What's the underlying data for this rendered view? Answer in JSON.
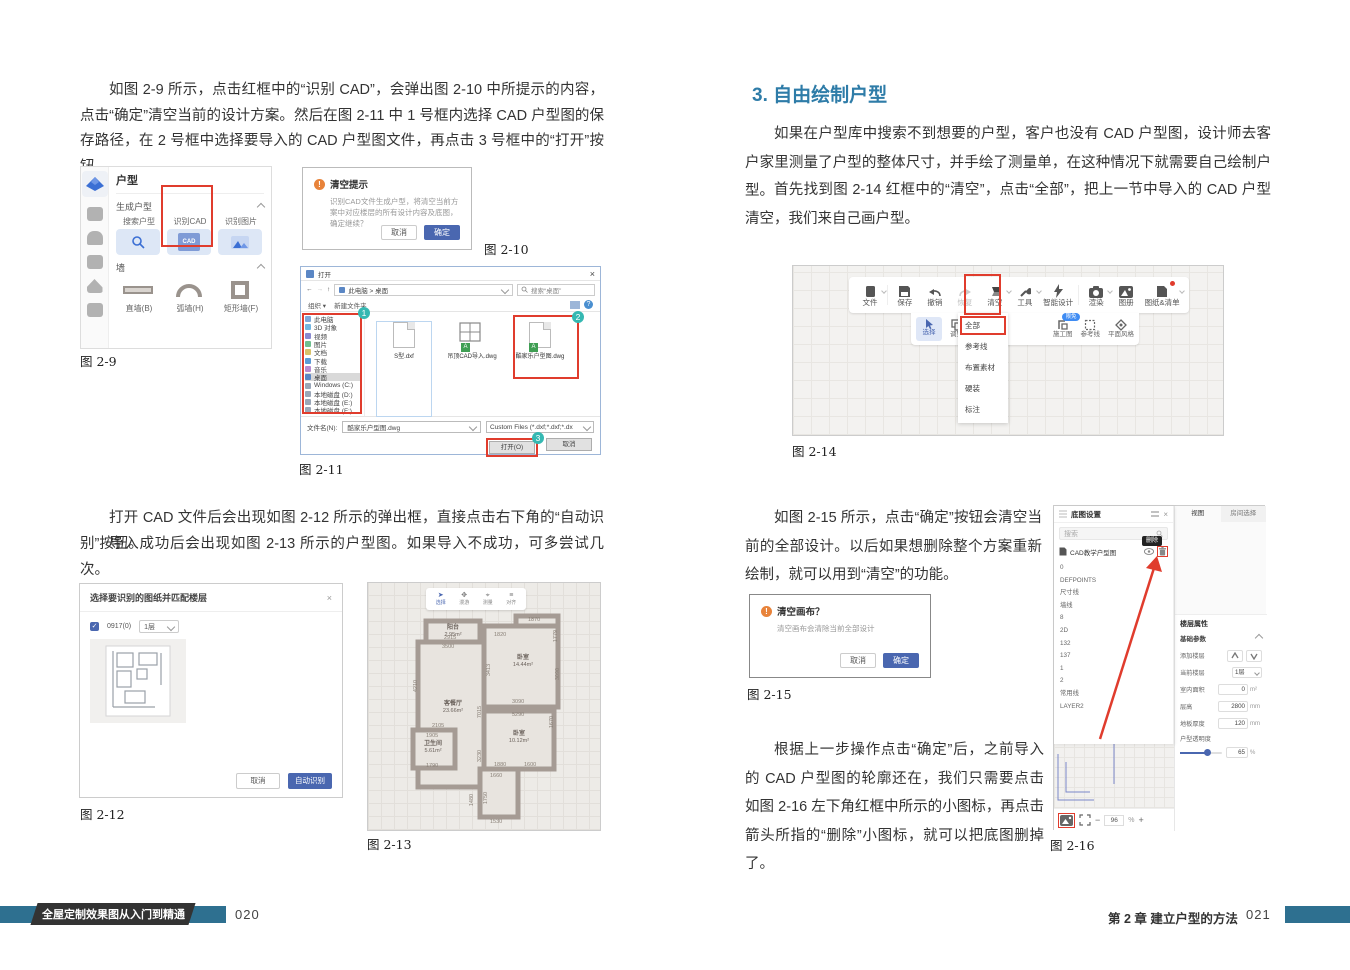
{
  "pl": {
    "para1": "如图 2-9 所示，点击红框中的“识别 CAD”，会弹出图 2-10 中所提示的内容，点击“确定”清空当前的设计方案。然后在图 2-11 中 1 号框内选择 CAD 户型图的保存路径，在 2 号框中选择要导入的 CAD 户型图文件，再点击 3 号框中的“打开”按钮。",
    "para2a": "打开 CAD 文件后会出现如图 2-12 所示的弹出框，直接点击右下角的“自动识别”按钮。",
    "para2b": "导入成功后会出现如图 2-13 所示的户型图。如果导入不成功，可多尝试几次。",
    "fig9": {
      "caption": "图 2-9",
      "title": "户型",
      "sec1": "生成户型",
      "sec2": "墙",
      "tiles": [
        "搜索户型",
        "识别CAD",
        "识别图片"
      ],
      "cad_label": "CAD",
      "walls": [
        "直墙(B)",
        "弧墙(H)",
        "矩形墙(F)"
      ]
    },
    "fig10": {
      "caption": "图 2-10",
      "title": "清空提示",
      "warn": "!",
      "body": "识别CAD文件生成户型，将清空当前方案中对应楼层的所有设计内容及底图，确定继续？",
      "cancel": "取消",
      "ok": "确定"
    },
    "fig11": {
      "caption": "图 2-11",
      "title": "打开",
      "close": "×",
      "back": "←",
      "fwd": "→",
      "up": "↑",
      "crumb": "此电脑 > 桌面",
      "search": "搜索“桌面”",
      "organize": "组织 ▾",
      "newfolder": "新建文件夹",
      "sidebar": [
        "此电脑",
        "3D 对象",
        "视频",
        "图片",
        "文档",
        "下载",
        "音乐",
        "桌面",
        "Windows (C:)",
        "本地磁盘 (D:)",
        "本地磁盘 (E:)",
        "本地磁盘 (F:)"
      ],
      "files": [
        "S型.dxf",
        "吊顶CAD导入.dwg",
        "酷家乐户型图.dwg"
      ],
      "file_badge": "A",
      "filename_label": "文件名(N):",
      "filename_value": "酷家乐户型图.dwg",
      "filter": "Custom Files (*.dxf;*.dxf;*.dx",
      "open": "打开(O)",
      "cancel": "取消",
      "badges": [
        "1",
        "2",
        "3"
      ]
    },
    "fig12": {
      "caption": "图 2-12",
      "title": "选择要识别的图纸并匹配楼层",
      "close": "×",
      "check": "✓",
      "check_label": "0917(0)",
      "floor_dd": "1层",
      "cancel": "取消",
      "auto": "自动识别"
    },
    "fig13": {
      "caption": "图 2-13",
      "tools": [
        "选择",
        "漫游",
        "测量",
        "对齐"
      ],
      "rooms": [
        {
          "name": "阳台",
          "area": "2.95m²"
        },
        {
          "name": "卧室",
          "area": "14.44m²"
        },
        {
          "name": "客餐厅",
          "area": "23.66m²"
        },
        {
          "name": "卫生间",
          "area": "5.61m²"
        },
        {
          "name": "卧室",
          "area": "10.12m²"
        }
      ],
      "dims": [
        "3500",
        "1870",
        "1820",
        "1779",
        "2915",
        "4210",
        "7015",
        "3413",
        "3090",
        "3090",
        "5290",
        "1670",
        "2105",
        "1905",
        "1790",
        "1880",
        "1600",
        "1660",
        "3230",
        "1750",
        "1480",
        "1530"
      ]
    }
  },
  "pr": {
    "heading": "3. 自由绘制户型",
    "para1": "如果在户型库中搜索不到想要的户型，客户也没有 CAD 户型图，设计师去客户家里测量了户型的整体尺寸，并手绘了测量单，在这种情况下就需要自己绘制户型。",
    "para2": "首先找到图 2-14 红框中的“清空”，点击“全部”，把上一节中导入的 CAD 户型清空，我们来自己画户型。",
    "para3": "如图 2-15 所示，点击“确定”按钮会清空当前的全部设计。以后如果想删除整个方案重新绘制，就可以用到“清空”的功能。",
    "para4": "根据上一步操作点击“确定”后，之前导入的 CAD 户型图的轮廓还在，我们只需要点击如图 2-16 左下角红框中所示的小图标，再点击箭头所指的“删除”小图标，就可以把底图删掉了。",
    "fig14": {
      "caption": "图 2-14",
      "toolbar": [
        "文件",
        "保存",
        "撤销",
        "恢复",
        "清空",
        "工具",
        "智能设计",
        "渲染",
        "图册",
        "图纸&清单"
      ],
      "row2": [
        "选择",
        "调整",
        "施工图",
        "参考线",
        "平面风格"
      ],
      "badge": "限免",
      "menu": [
        "全部",
        "参考线",
        "布置素材",
        "硬装",
        "标注"
      ]
    },
    "fig15": {
      "caption": "图 2-15",
      "title": "清空画布？",
      "warn": "!",
      "body": "清空画布会清除当前全部设计",
      "cancel": "取消",
      "ok": "确定"
    },
    "fig16": {
      "caption": "图 2-16",
      "panel_title": "底图设置",
      "close": "×",
      "search": "搜索",
      "tooltip": "删除",
      "main_layer": "CAD教学户型图",
      "layers": [
        "0",
        "DEFPOINTS",
        "尺寸线",
        "墙线",
        "8",
        "2D",
        "132",
        "137",
        "1",
        "2",
        "常用线",
        "LAYER2"
      ],
      "tabs": [
        "视图",
        "房间选择"
      ],
      "props_title": "楼层属性",
      "props_sec": "基础参数",
      "rows": {
        "add_floor": "添加楼层",
        "cur_floor": "当前楼层",
        "cur_floor_val": "1层",
        "area": "室内面积",
        "area_val": "0",
        "area_unit": "m²",
        "height": "层高",
        "height_val": "2800",
        "height_unit": "mm",
        "slab": "地板厚度",
        "slab_val": "120",
        "slab_unit": "mm",
        "opacity": "户型透明度",
        "opacity_val": "65",
        "opacity_unit": "%"
      },
      "zoom_val": "96",
      "zoom_unit": "%",
      "zoom_minus": "−",
      "zoom_plus": "+"
    }
  },
  "footer": {
    "book_title": "全屋定制效果图从入门到精通",
    "page_left": "020",
    "chapter": "第 2 章  建立户型的方法",
    "page_right": "021"
  },
  "colors": {
    "accent_red": "#e03c2d",
    "primary_blue": "#4a67b0",
    "heading_blue": "#2e7ca8",
    "footer_teal": "#2e7090",
    "badge_cyan": "#35b8b2",
    "badge_blue": "#3f8cf3"
  }
}
